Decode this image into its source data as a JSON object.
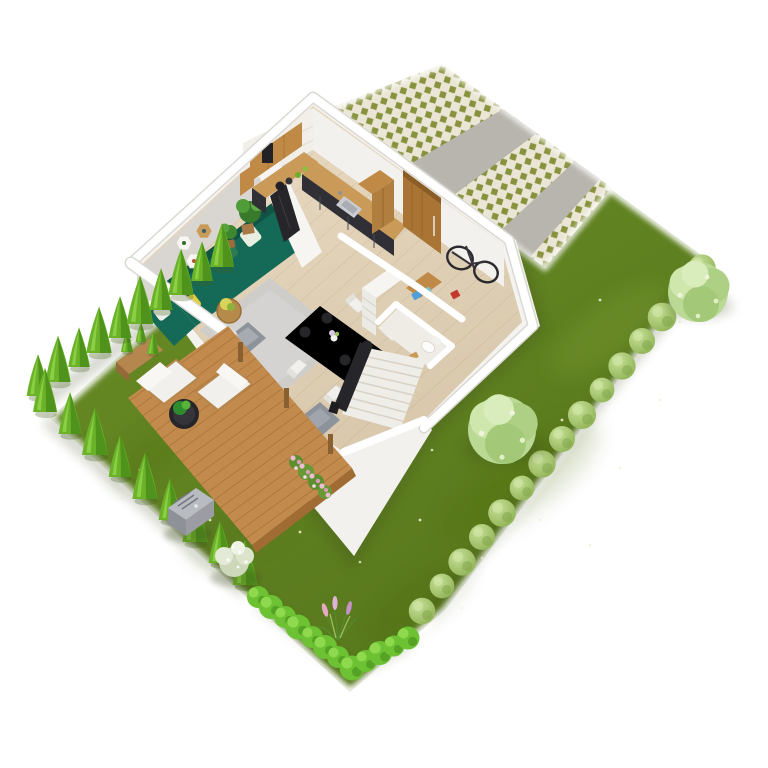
{
  "meta": {
    "kind": "3d-isometric-floor-plan-render",
    "view": "birds-eye cutaway of single-story house with landscaped yard",
    "background": "#ffffff"
  },
  "colors": {
    "background": "#ffffff",
    "lawn_base": "#6d9127",
    "lawn_dark": "#54751b",
    "conifer_green": "#6ab227",
    "conifer_shade": "#4f921c",
    "conifer_highlight": "#8fd34a",
    "boxwood_green": "#9cc25e",
    "hedge_green": "#6cc232",
    "hedge_light": "#8fd94f",
    "hedge_shade": "#55a224",
    "tree_pale": "#b9d994",
    "paver_base": "#eae5d4",
    "paver_green": "#87923c",
    "concrete_gray": "#b8b5ae",
    "wall_white": "#ffffff",
    "wall_face": "#f3f1ee",
    "wall_gray": "#d9d6d2",
    "base_white": "#f4f3f0",
    "floor_wood": "#e9dbc3",
    "floor_seam": "#d9c5a7",
    "deck_wood": "#c28a4c",
    "deck_seam": "#a06c34",
    "counter_wood": "#c99a58",
    "cabinet_black": "#2f2f35",
    "cabinet_wood": "#c08a46",
    "door_wood": "#a97434",
    "sofa_teal": "#156a57",
    "sofa_teal_dark": "#0f5444",
    "rug_gray": "#cdccca",
    "armchair_gray": "#8d939b",
    "chair_white": "#f1f0ed",
    "plate_black": "#26262a",
    "stair_rail_black": "#26262a",
    "bike_black": "#2a2a2e",
    "mower_gray": "#9b9ca4",
    "flower_pink": "#e4a9c3",
    "steel": "#c9cdd1",
    "plant_green": "#3d8c2f",
    "shadow_green": "#3e4a1c"
  },
  "garden": {
    "conifers_northwest_row": 10,
    "conifers_southwest_row": 9,
    "boxwood_bushes_east_row": 15,
    "hedge_blobs": 12,
    "hedge_segments": 2,
    "lawn_trees": 2,
    "white_flower_bushes": 1,
    "rose_bushes": 1,
    "ornamental_grasses": 1,
    "robotic_mower": 1
  },
  "driveway": {
    "paver_bands": 3,
    "concrete_bands": 2,
    "surface": "grass-paver lattice with concrete strips"
  },
  "deck": {
    "chairs": 2,
    "table": 1,
    "planter_conifers": 3,
    "posts": 3
  },
  "house": {
    "rooms": [
      "living-room",
      "kitchen",
      "dining-area",
      "hallway",
      "bathroom",
      "staircase"
    ],
    "furnishings": {
      "sofa": 1,
      "sofa_pillows": 4,
      "rug": 1,
      "coffee_table": 1,
      "armchairs": 2,
      "wall_shelves": 3,
      "potted_plants": 3,
      "tv_panel": 1,
      "dining_table": 1,
      "dining_chairs": 4,
      "plates": 4,
      "vase": 1,
      "kitchen_counter_runs": 2,
      "sink": 1,
      "stove_pots": 2,
      "upper_cabinets": 2,
      "tall_cabinet": 1,
      "front_door": 1,
      "bicycle": 1,
      "shoe_bench": 1,
      "dresser": 1,
      "toilet": 1,
      "stair_treads": 8,
      "stair_railing": 1
    }
  }
}
